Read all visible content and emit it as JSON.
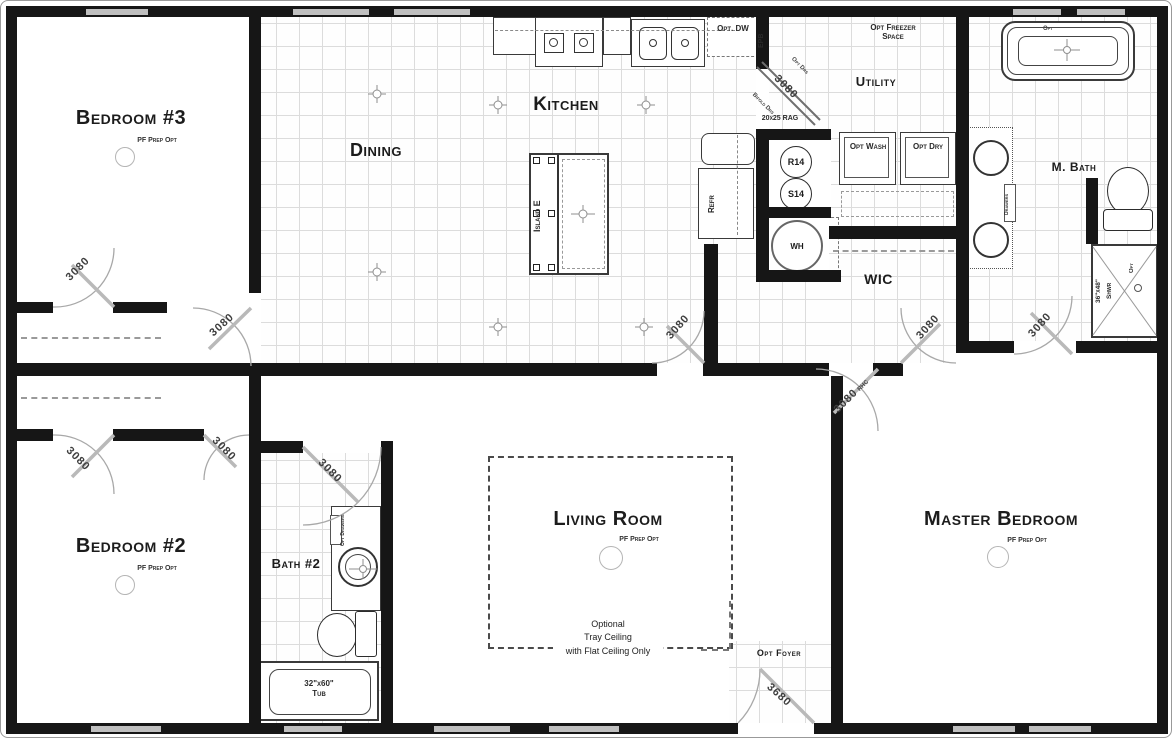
{
  "rooms": {
    "bedroom3": {
      "name": "Bedroom #3",
      "note": "PF Prep Opt"
    },
    "bedroom2": {
      "name": "Bedroom #2",
      "note": "PF Prep Opt"
    },
    "master": {
      "name": "Master Bedroom",
      "note": "PF Prep Opt"
    },
    "living": {
      "name": "Living Room",
      "note": "PF Prep Opt",
      "tray1": "Optional",
      "tray2": "Tray Ceiling",
      "tray3": "with Flat Ceiling Only"
    },
    "dining": {
      "name": "Dining"
    },
    "kitchen": {
      "name": "Kitchen"
    },
    "utility": {
      "name": "Utility",
      "freezer": "Opt Freezer Space"
    },
    "mbath": {
      "name": "M. Bath"
    },
    "wic": {
      "name": "WIC"
    },
    "bath2": {
      "name": "Bath #2"
    },
    "foyer": {
      "name": "Opt Foyer"
    }
  },
  "fixtures": {
    "island": "Island E",
    "refrigerator": "Refr",
    "water_heater": "WH",
    "r14": "R14",
    "s14": "S14",
    "washer": "Opt Wash",
    "dryer": "Opt Dry",
    "dishwasher": "Opt. DW",
    "electrical_panel": "EPB",
    "return_air_grille": "20x25 RAG",
    "master_tub_opt": "Opt",
    "shower_size": "36\"x48\"",
    "shower_name": "Shwr",
    "shower_opt": "Opt",
    "tub2_size": "32\"x60\"",
    "tub2_name": "Tub",
    "bath2_vanity_drawers": "Opt Drawers",
    "mbath_vanity_drawers": "Drawers"
  },
  "doors": {
    "bed3": "3080",
    "closet3": "3080",
    "closet2": "3080",
    "bed2": "3080",
    "bath2": "3080",
    "hall": "3080",
    "utility": "3080",
    "utility_note_top": "Opt Drs",
    "utility_note_bottom": "Bifold Drs",
    "master": "3080",
    "master_hinge": "RHC",
    "wic": "3080",
    "mbath": "3080",
    "entry": "3680"
  },
  "colors": {
    "wall": "#161616",
    "grid": "#dcdcdc",
    "door_line": "#a8a8a8"
  }
}
